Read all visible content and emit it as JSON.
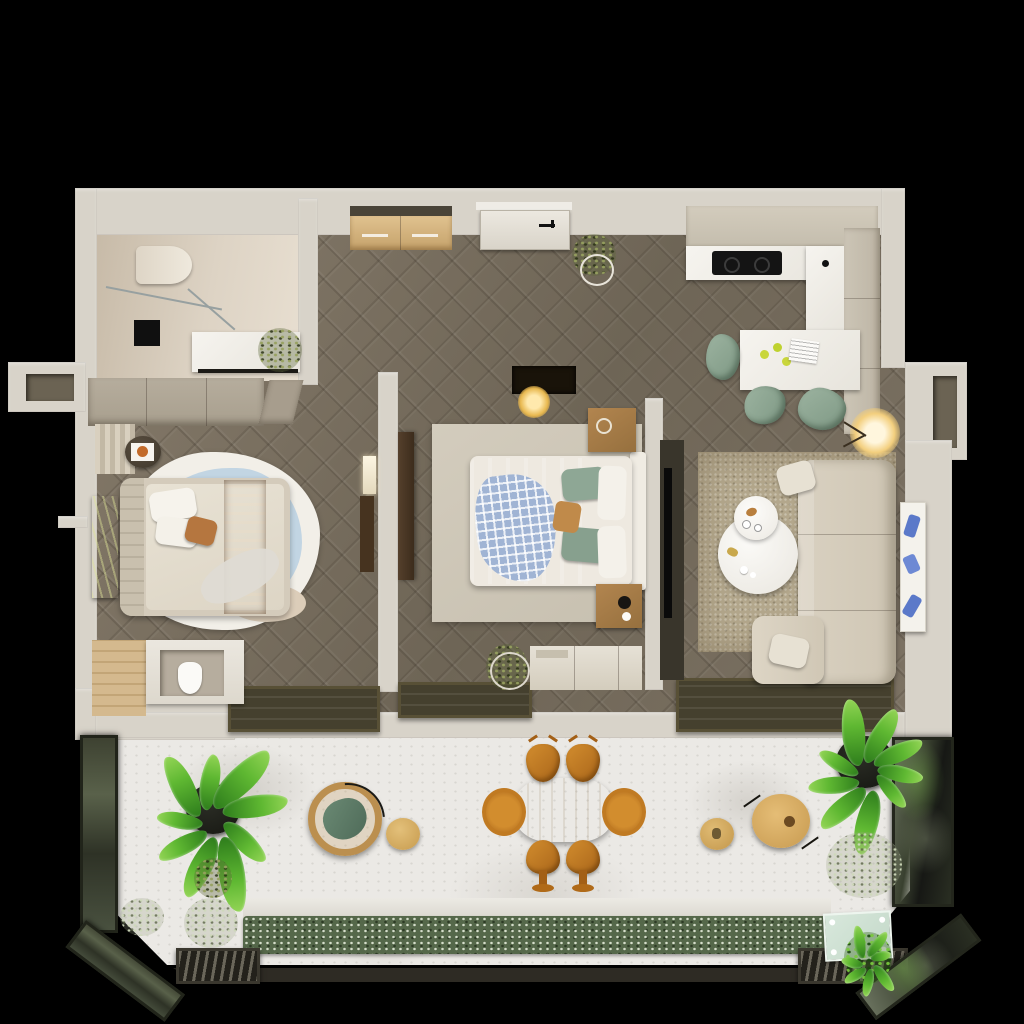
{
  "scene": {
    "kind": "3d-rendered-apartment-floor-plan-top-view",
    "visible_text": [],
    "background": "black"
  },
  "palette": {
    "bg": "#000000",
    "wall": "#d8d3c9",
    "wood_floor": "#7f7566",
    "bath_floor": "#d8cdbc",
    "marble_terrace": "#ebe9e5",
    "window_frame_dark": "#45402e",
    "sofa_beige": "#d9d1c1",
    "terracotta_throw": "#a8622e",
    "sage_green": "#8ea795",
    "caramel_chair": "#c07a22",
    "hedge_green": "#55684a",
    "leaf_green": "#5fb832",
    "glow_warm": "#f3cf7e",
    "mint_glass": "#cfe2d4",
    "rug_blue": "#c2d5e3"
  },
  "rooms": [
    {
      "name": "bathroom",
      "items": [
        "toilet",
        "shower-glass-screen",
        "black-floor-mat",
        "vanity-with-plant"
      ]
    },
    {
      "name": "entry-hall",
      "items": [
        "console-sideboard",
        "entrance-door",
        "potted-plant"
      ]
    },
    {
      "name": "kitchen",
      "items": [
        "upper-cabinets",
        "counter-with-cooktop",
        "sink-counter",
        "tall-cabinets",
        "island-dining-table",
        "three-sage-chairs",
        "limes",
        "magazine"
      ]
    },
    {
      "name": "bedroom-1",
      "items": [
        "wardrobe",
        "round-side-table-with-art",
        "green-wall-art",
        "organic-rug",
        "double-bed",
        "terracotta-throw",
        "pillows",
        "wc-block-with-toilet",
        "wood-deck-strip"
      ]
    },
    {
      "name": "bedroom-2",
      "items": [
        "dark-door-leaf",
        "pendant-lamp",
        "square-rug",
        "double-bed",
        "gingham-throw",
        "sage-pillows",
        "two-nightstands",
        "low-wardrobe",
        "potted-plant"
      ]
    },
    {
      "name": "living-room",
      "items": [
        "tv-panel",
        "textured-rug",
        "sectional-sofa",
        "two-round-coffee-tables",
        "floor-lamp",
        "leaning-blue-artwork",
        "sliding-glass-window"
      ]
    },
    {
      "name": "balcony-terrace",
      "items": [
        "banana-plant-left",
        "pale-shrubs",
        "hanging-rattan-chair",
        "gold-side-table",
        "oval-dining-table",
        "six-caramel-chairs",
        "pouf-table",
        "round-wood-lounge-chair",
        "banana-plant-right",
        "pale-fern",
        "mint-glass-panel",
        "hedge-planter",
        "two-drain-grates",
        "glass-railings"
      ]
    }
  ],
  "counts": {
    "outdoor_dining_chairs": 6,
    "kitchen_chairs": 3,
    "bedrooms": 2,
    "coffee_tables": 2,
    "drain_grates": 2
  },
  "plants": [
    {
      "id": "banana-left",
      "cx": 212,
      "cy": 812,
      "leaves": 9,
      "base_angle": 200,
      "min_len": 46,
      "max_len": 78
    },
    {
      "id": "banana-right",
      "cx": 868,
      "cy": 766,
      "leaves": 9,
      "base_angle": 60,
      "min_len": 42,
      "max_len": 72
    },
    {
      "id": "grate-plant",
      "cx": 868,
      "cy": 958,
      "leaves": 7,
      "base_angle": 0,
      "min_len": 20,
      "max_len": 34
    }
  ]
}
